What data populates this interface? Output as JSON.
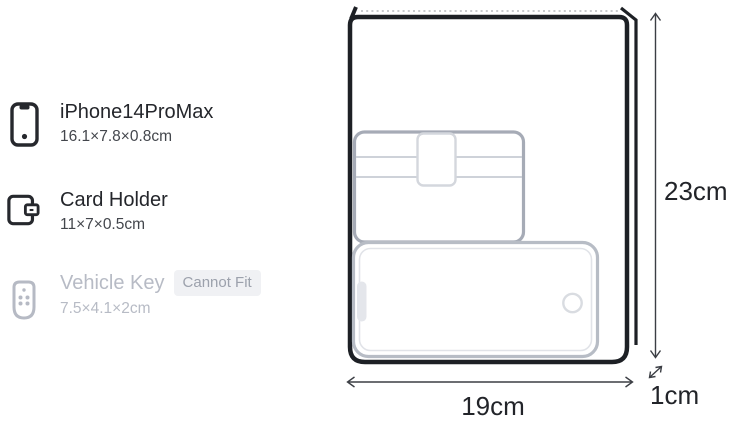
{
  "sidebar": {
    "items": [
      {
        "name": "iPhone14ProMax",
        "dims": "16.1×7.8×0.8cm",
        "icon": "smartphone-icon",
        "fits": true
      },
      {
        "name": "Card Holder",
        "dims": "11×7×0.5cm",
        "icon": "wallet-icon",
        "fits": true
      },
      {
        "name": "Vehicle Key",
        "dims": "7.5×4.1×2cm",
        "icon": "key-fob-icon",
        "fits": false,
        "badge": "Cannot Fit"
      }
    ]
  },
  "diagram": {
    "bag": {
      "width_cm": 19,
      "height_cm": 23,
      "depth_cm": 1
    },
    "labels": {
      "height": "23cm",
      "width": "19cm",
      "depth": "1cm"
    },
    "items_shown": [
      "Card Holder",
      "iPhone14ProMax"
    ]
  },
  "colors": {
    "outline_dark": "#1d2025",
    "item_outline_gray": "#a6abb6",
    "phone_outline_gray": "#b7bcc5",
    "disabled_gray": "#b7bbc5",
    "badge_bg": "#f0f1f4",
    "badge_text": "#9ca1ac"
  }
}
